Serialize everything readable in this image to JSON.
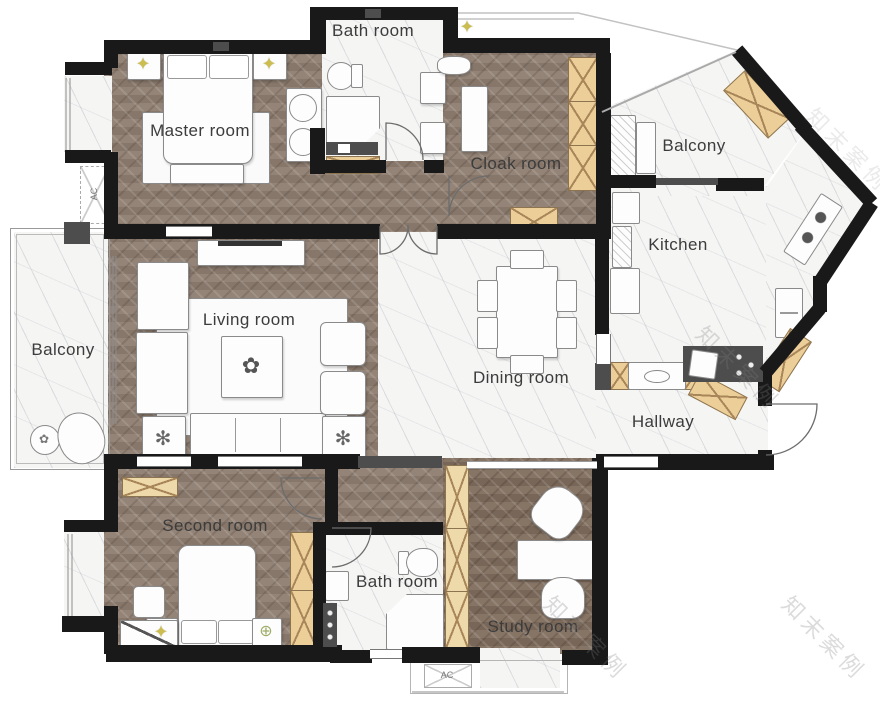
{
  "type": "floor-plan",
  "rooms": [
    {
      "id": "bath-top",
      "label": "Bath room"
    },
    {
      "id": "master",
      "label": "Master room"
    },
    {
      "id": "cloak",
      "label": "Cloak room"
    },
    {
      "id": "balcony-right",
      "label": "Balcony"
    },
    {
      "id": "kitchen",
      "label": "Kitchen"
    },
    {
      "id": "living",
      "label": "Living room"
    },
    {
      "id": "dining",
      "label": "Dining room"
    },
    {
      "id": "hallway",
      "label": "Hallway"
    },
    {
      "id": "balcony-left",
      "label": "Balcony"
    },
    {
      "id": "second",
      "label": "Second room"
    },
    {
      "id": "bath-bottom",
      "label": "Bath room"
    },
    {
      "id": "study",
      "label": "Study room"
    }
  ],
  "labels": {
    "ac": "AC"
  },
  "watermark": {
    "text": "知末案例"
  },
  "icons": {
    "ceiling-light": "✦",
    "fan": "✻",
    "plant": "✿",
    "crosshair": "⊕"
  },
  "colors": {
    "wall": "#191919",
    "wood": "#8e7d70",
    "wood_dark": "#806d5d",
    "marble": "#f5f5f4",
    "cabinet": "#ecce98",
    "counter": "#4d4d4d",
    "light": "#cdbd4f"
  }
}
